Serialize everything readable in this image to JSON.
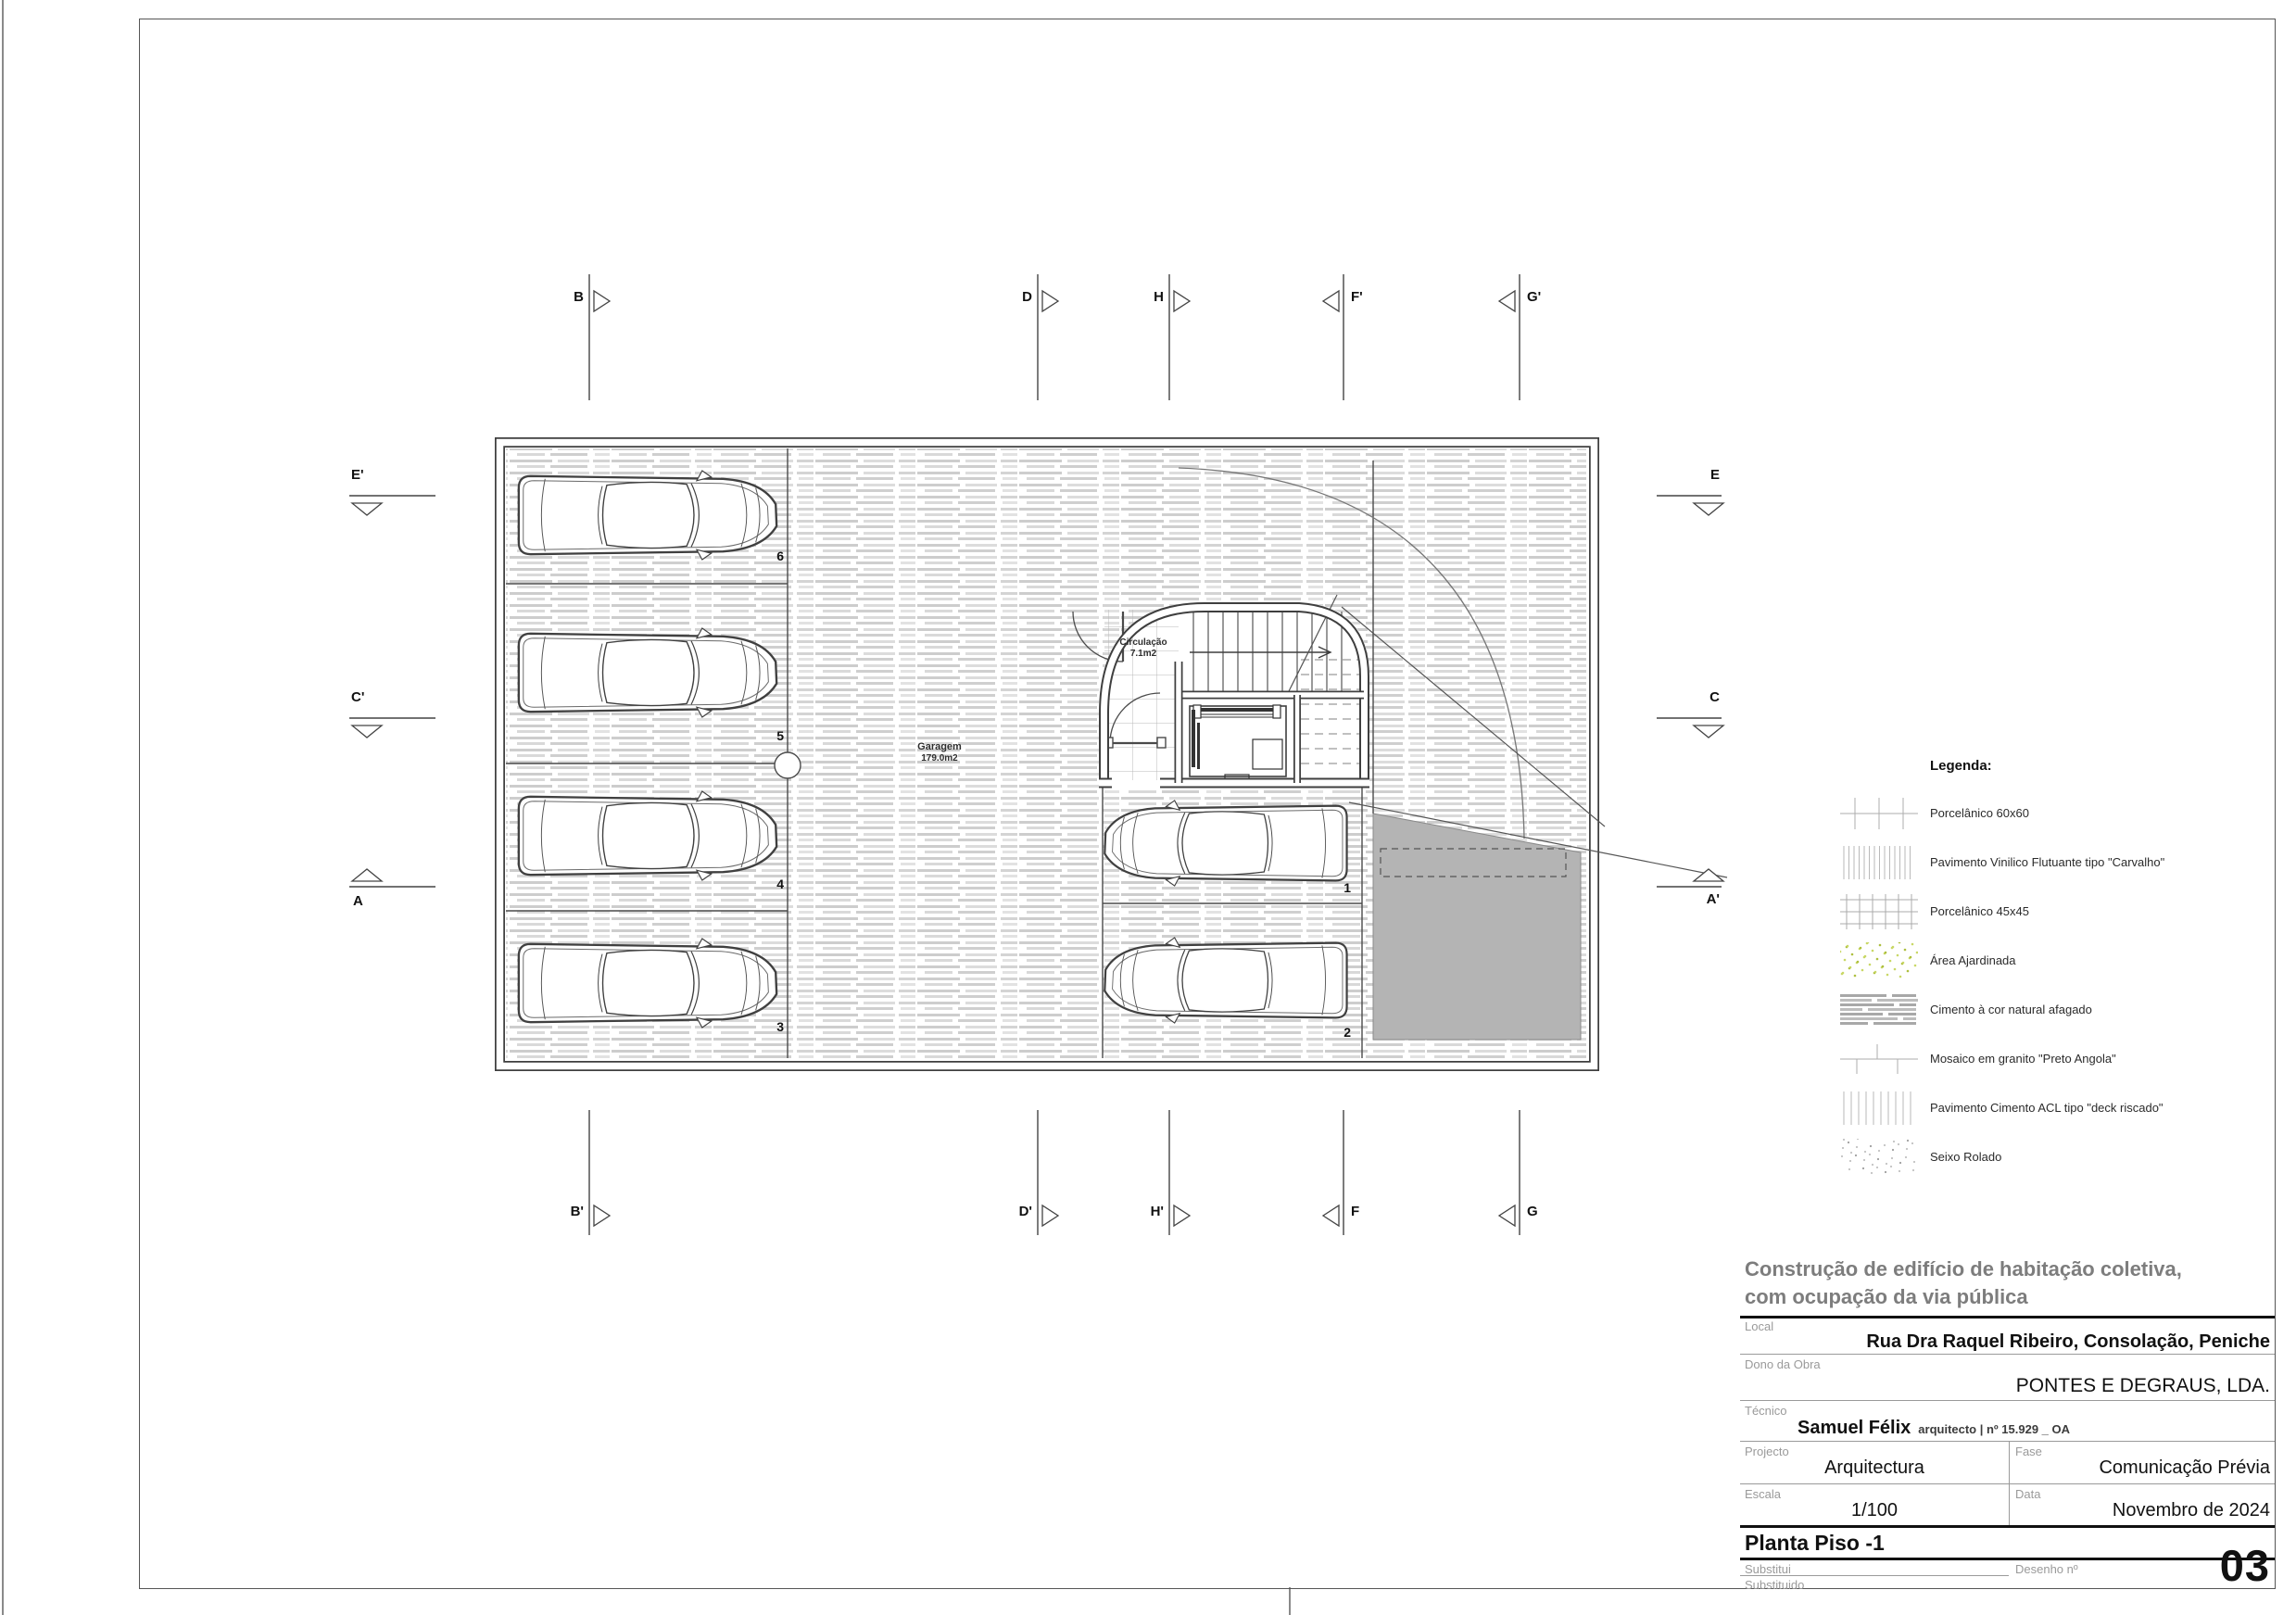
{
  "title_block": {
    "project_title": [
      "Construção de edifício de habitação coletiva,",
      "com ocupação da via pública"
    ],
    "local_label": "Local",
    "local_value": "Rua Dra Raquel Ribeiro, Consolação, Peniche",
    "dono_label": "Dono da Obra",
    "dono_value": "PONTES E DEGRAUS, LDA.",
    "tecnico_label": "Técnico",
    "tecnico_value": "Samuel Félix",
    "tecnico_detail": "arquitecto | nº 15.929 _ OA",
    "projecto_label": "Projecto",
    "projecto_value": "Arquitectura",
    "fase_label": "Fase",
    "fase_value": "Comunicação Prévia",
    "escala_label": "Escala",
    "escala_value": "1/100",
    "data_label": "Data",
    "data_value": "Novembro de 2024",
    "drawing_name": "Planta Piso -1",
    "substitui_label": "Substitui",
    "substituido_label": "Substituido",
    "desenho_label": "Desenho nº",
    "desenho_value": "03"
  },
  "legend": {
    "title": "Legenda:",
    "items": [
      {
        "id": "porcelanico-60x60",
        "label": "Porcelânico 60x60"
      },
      {
        "id": "vinilico-carvalho",
        "label": "Pavimento Vinilico Flutuante tipo \"Carvalho\""
      },
      {
        "id": "porcelanico-45x45",
        "label": "Porcelânico 45x45"
      },
      {
        "id": "area-ajardinada",
        "label": "Área Ajardinada"
      },
      {
        "id": "cimento-afagado",
        "label": "Cimento à cor natural afagado"
      },
      {
        "id": "mosaico-granito",
        "label": "Mosaico em granito \"Preto Angola\""
      },
      {
        "id": "deck-riscado",
        "label": "Pavimento Cimento ACL tipo \"deck riscado\""
      },
      {
        "id": "seixo-rolado",
        "label": "Seixo Rolado"
      }
    ]
  },
  "plan": {
    "rooms": [
      {
        "name": "Garagem",
        "area": "179.0m2"
      },
      {
        "name": "Circulação",
        "area": "7.1m2"
      }
    ],
    "parking_spaces": [
      "1",
      "2",
      "3",
      "4",
      "5",
      "6"
    ],
    "section_markers": {
      "top": [
        "B",
        "D",
        "H",
        "F'",
        "G'"
      ],
      "bottom": [
        "B'",
        "D'",
        "H'",
        "F",
        "G"
      ],
      "left": [
        "E'",
        "C'",
        "A"
      ],
      "right": [
        "E",
        "C",
        "A'"
      ]
    }
  },
  "colors": {
    "line": "#3f3f3f",
    "ramp_gray": "#b4b4b4",
    "garden_green": "#c9d867",
    "hatch_gray": "#d2d2d2",
    "title_gray": "#7d7d7d"
  }
}
